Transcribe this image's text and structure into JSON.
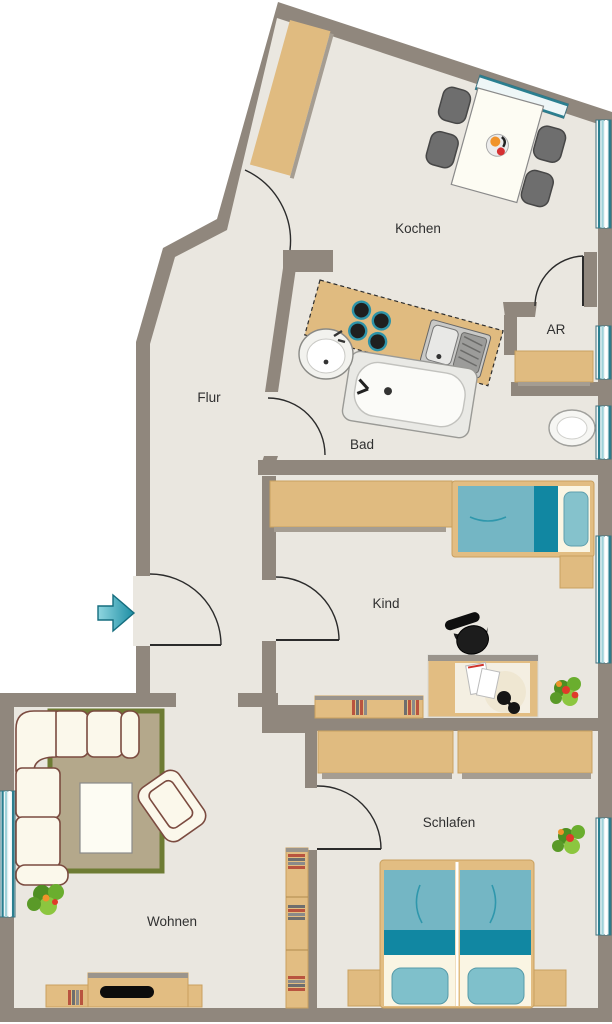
{
  "title": "Apartment floor plan",
  "floorplan": {
    "rooms": [
      {
        "id": "kochen",
        "label": "Kochen"
      },
      {
        "id": "ar",
        "label": "AR"
      },
      {
        "id": "flur",
        "label": "Flur"
      },
      {
        "id": "bad",
        "label": "Bad"
      },
      {
        "id": "kind",
        "label": "Kind"
      },
      {
        "id": "schlafen",
        "label": "Schlafen"
      },
      {
        "id": "wohnen",
        "label": "Wohnen"
      }
    ],
    "entrance": {
      "symbol": "entrance-arrow"
    },
    "colors": {
      "wall": "#90877d",
      "floor": "#eae7e0",
      "wood": "#e0bb80",
      "wood_edge": "#c9a05f",
      "shadow": "#a59d92",
      "teal_dark": "#1187a2",
      "teal_light": "#74b6c4",
      "pillow": "#85c2cc",
      "bed_white": "#faf5e3",
      "win_dark": "#2a7f90",
      "win_teal": "#9fd2d9",
      "sofa": "#fbf8eb",
      "sofa_line": "#7b4b40",
      "rug": "#b4a88b",
      "rug_border": "#6e7c34",
      "arrow": "#2aa5b8",
      "label": "#303030",
      "chair": "#6e6e6e"
    }
  }
}
